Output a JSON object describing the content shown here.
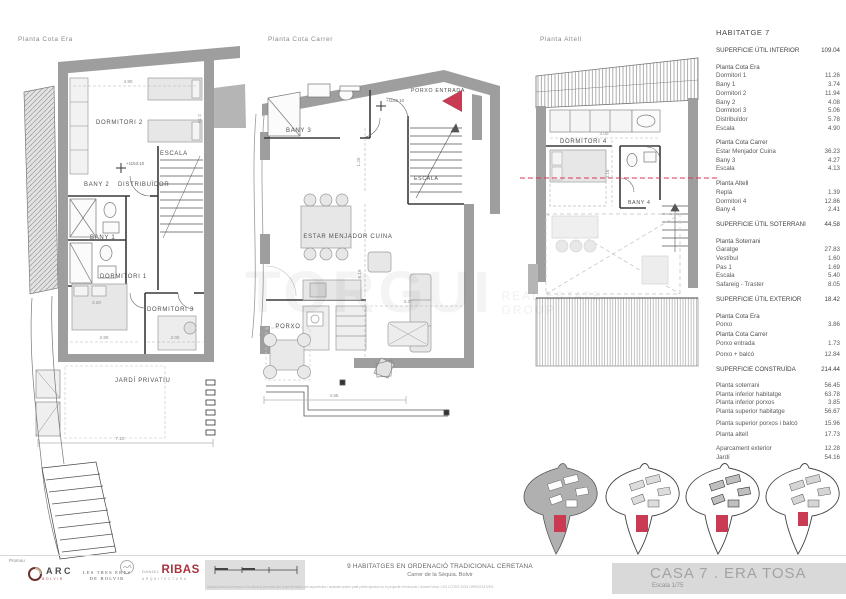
{
  "plans": {
    "era": {
      "title": "Planta Cota Era",
      "labels": {
        "dormitori2": "DORMITORI 2",
        "bany2": "BANY 2",
        "distribuidor": "DISTRIBUÏDOR",
        "escala": "ESCALA",
        "level": "+1153.10",
        "bany1": "BANY 1",
        "dormitori1": "DORMITORI 1",
        "dormitori3": "DORMITORI 3",
        "jardi": "JARDÍ PRIVATIU",
        "dim_490": "4.90",
        "dim_279": "2.79",
        "dim_320": "3.20",
        "dim_280": "2.80",
        "dim_200": "2.00",
        "dim_710": "7.10"
      }
    },
    "carrer": {
      "title": "Planta Cota Carrer",
      "labels": {
        "bany3": "BANY 3",
        "porxo_entrada": "PORXO ENTRADA",
        "level": "+1156.10",
        "escala": "ESCALA",
        "estar": "ESTAR MENJADOR CUINA",
        "porxo": "PORXO",
        "dim_120": "1.20",
        "dim_619": "6.19",
        "dim_327": "3.27",
        "dim_455": "4.55"
      }
    },
    "altell": {
      "title": "Planta Altell",
      "labels": {
        "dormitori4": "DORMITORI 4",
        "bany4": "BANY 4",
        "dim_300": "3.00",
        "dim_316": "3.16"
      }
    }
  },
  "table": {
    "title": "HABITATGE 7",
    "rows": [
      {
        "cls": "total",
        "label": "SUPERFICIE ÚTIL INTERIOR",
        "value": "109.04"
      },
      {
        "cls": "gap"
      },
      {
        "cls": "head",
        "label": "Planta Cota Era",
        "value": ""
      },
      {
        "cls": "item",
        "label": "Dormitori 1",
        "value": "11.26"
      },
      {
        "cls": "item",
        "label": "Bany 1",
        "value": "3.74"
      },
      {
        "cls": "item",
        "label": "Dormitori 2",
        "value": "11.94"
      },
      {
        "cls": "item",
        "label": "Bany 2",
        "value": "4.08"
      },
      {
        "cls": "item",
        "label": "Dormitori 3",
        "value": "5.06"
      },
      {
        "cls": "item",
        "label": "Distribuïdor",
        "value": "5.78"
      },
      {
        "cls": "item",
        "label": "Escala",
        "value": "4.90"
      },
      {
        "cls": "gap"
      },
      {
        "cls": "head",
        "label": "Planta Cota Carrer",
        "value": ""
      },
      {
        "cls": "item",
        "label": "Estar Menjador Cuina",
        "value": "36.23"
      },
      {
        "cls": "item",
        "label": "Bany 3",
        "value": "4.27"
      },
      {
        "cls": "item",
        "label": "Escala",
        "value": "4.13"
      },
      {
        "cls": "gap"
      },
      {
        "cls": "head",
        "label": "Planta Altell",
        "value": ""
      },
      {
        "cls": "item",
        "label": "Replà",
        "value": "1.39"
      },
      {
        "cls": "item",
        "label": "Dormitori 4",
        "value": "12.86"
      },
      {
        "cls": "item",
        "label": "Bany 4",
        "value": "2.41"
      },
      {
        "cls": "gap"
      },
      {
        "cls": "total",
        "label": "SUPERFICIE ÚTIL SOTERRANI",
        "value": "44.58"
      },
      {
        "cls": "gap"
      },
      {
        "cls": "head",
        "label": "Planta Soterrani",
        "value": ""
      },
      {
        "cls": "item",
        "label": "Garatge",
        "value": "27.83"
      },
      {
        "cls": "item",
        "label": "Vestíbul",
        "value": "1.60"
      },
      {
        "cls": "item",
        "label": "Pas 1",
        "value": "1.69"
      },
      {
        "cls": "item",
        "label": "Escala",
        "value": "5.40"
      },
      {
        "cls": "item",
        "label": "Safareig - Traster",
        "value": "8.05"
      },
      {
        "cls": "gap"
      },
      {
        "cls": "total",
        "label": "SUPERFICIE ÚTIL EXTERIOR",
        "value": "18.42"
      },
      {
        "cls": "gap"
      },
      {
        "cls": "head",
        "label": "Planta Cota Era",
        "value": ""
      },
      {
        "cls": "item",
        "label": "Porxo",
        "value": "3.86"
      },
      {
        "cls": "head",
        "label": "Planta Cota Carrer",
        "value": ""
      },
      {
        "cls": "item",
        "label": "Porxo entrada",
        "value": "1.73"
      },
      {
        "cls": "gapsm"
      },
      {
        "cls": "item",
        "label": "Porxo + balcó",
        "value": "12.84"
      },
      {
        "cls": "gap"
      },
      {
        "cls": "total",
        "label": "SUPERFICIE CONSTRUÏDA",
        "value": "214.44"
      },
      {
        "cls": "gap"
      },
      {
        "cls": "item",
        "label": "Planta soterrani",
        "value": "56.45"
      },
      {
        "cls": "item",
        "label": "Planta inferior habitatge",
        "value": "63.78"
      },
      {
        "cls": "item",
        "label": "Planta inferior porxos",
        "value": "3.85"
      },
      {
        "cls": "item",
        "label": "Planta superior habitatge",
        "value": "56.67"
      },
      {
        "cls": "gapsm"
      },
      {
        "cls": "item",
        "label": "Planta superior porxos i balcó",
        "value": "15.96"
      },
      {
        "cls": "gapsm"
      },
      {
        "cls": "item",
        "label": "Planta altell",
        "value": "17.73"
      },
      {
        "cls": "gap"
      },
      {
        "cls": "item",
        "label": "Aparcament exterior",
        "value": "12.28"
      },
      {
        "cls": "item",
        "label": "Jardí",
        "value": "54.16"
      }
    ]
  },
  "watermark": {
    "word": "TORGUI",
    "line1": "REAL ESTATE",
    "line2": "GROUP"
  },
  "footer": {
    "promou": "Promou",
    "arc": "ARC",
    "arc_sub": "BOLVIR",
    "eres_line1": "LES TRES ERES",
    "eres_line2": "DE BOLVIR",
    "ribas_pre": "DANIEL",
    "ribas": "RIBAS",
    "ribas_sub": "ARQUITECTURA",
    "project_line1": "9 HABITATGES EN ORDENACIÓ TRADICIONAL CERETANA",
    "project_line2": "Carrer de la Sèquia. Bolvir",
    "disclaimer": "Aquest plànol correspon a la situació prevista del projecte bàsic; les superfícies i acabats poden patir petits ajustos en el projecte d'execució i durant l'obra.  LES COTES SÓN ORIENTATIVES.",
    "sheet_title": "CASA 7 . ERA TOSA",
    "sheet_scale": "Escala 1/75"
  },
  "colors": {
    "wall_gray": "#9e9e9e",
    "accent_red": "#c93b52",
    "furniture": "#e7e7e7"
  }
}
